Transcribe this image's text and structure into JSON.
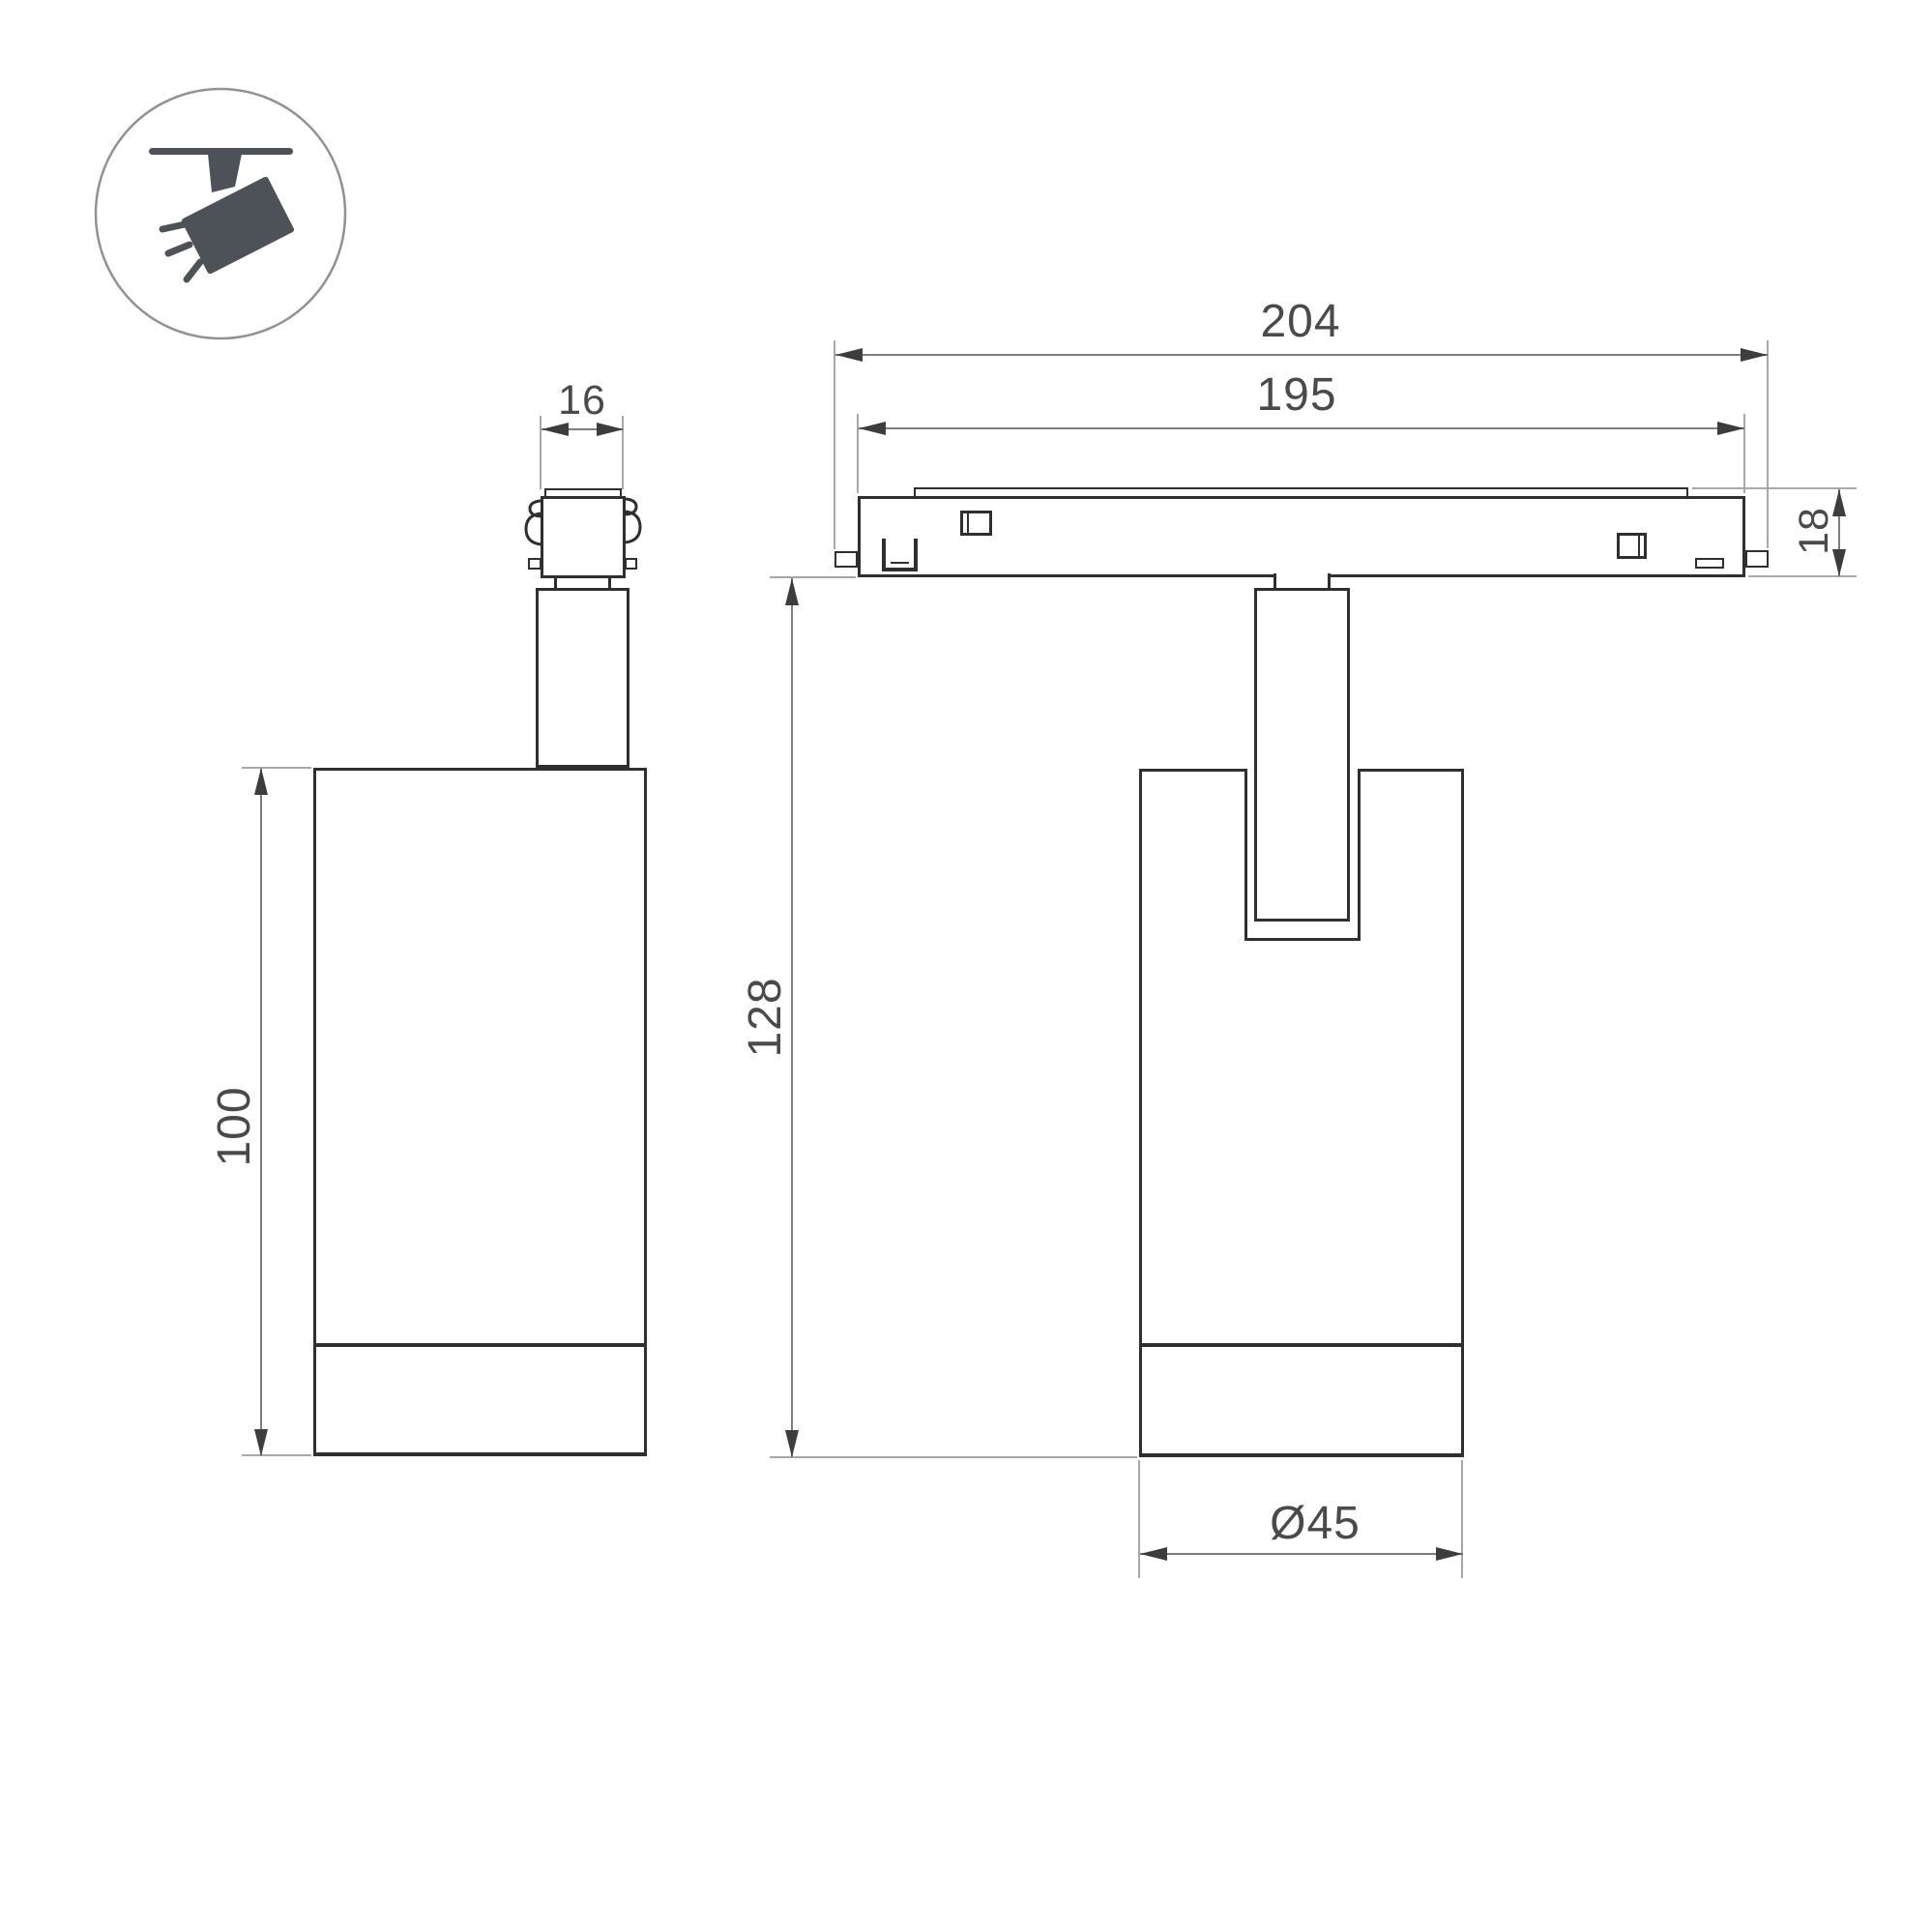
{
  "drawing": {
    "title": "track spotlight dimension drawing",
    "dimensions": {
      "track_length": "204",
      "track_inner_length": "195",
      "adapter_width": "16",
      "track_height": "18",
      "body_height": "100",
      "overall_height": "128",
      "body_diameter": "Ø45"
    },
    "icon": {
      "name": "track-spotlight-icon"
    }
  },
  "colors": {
    "bg": "#ffffff",
    "outline": "#2f2f2f",
    "dimline": "#7d7d7d",
    "extline": "#a8a8a8",
    "arrow": "#3d3d3d",
    "dimtext": "#4a4a4a",
    "icon": "#4c5257",
    "iconring": "#8f9396"
  }
}
